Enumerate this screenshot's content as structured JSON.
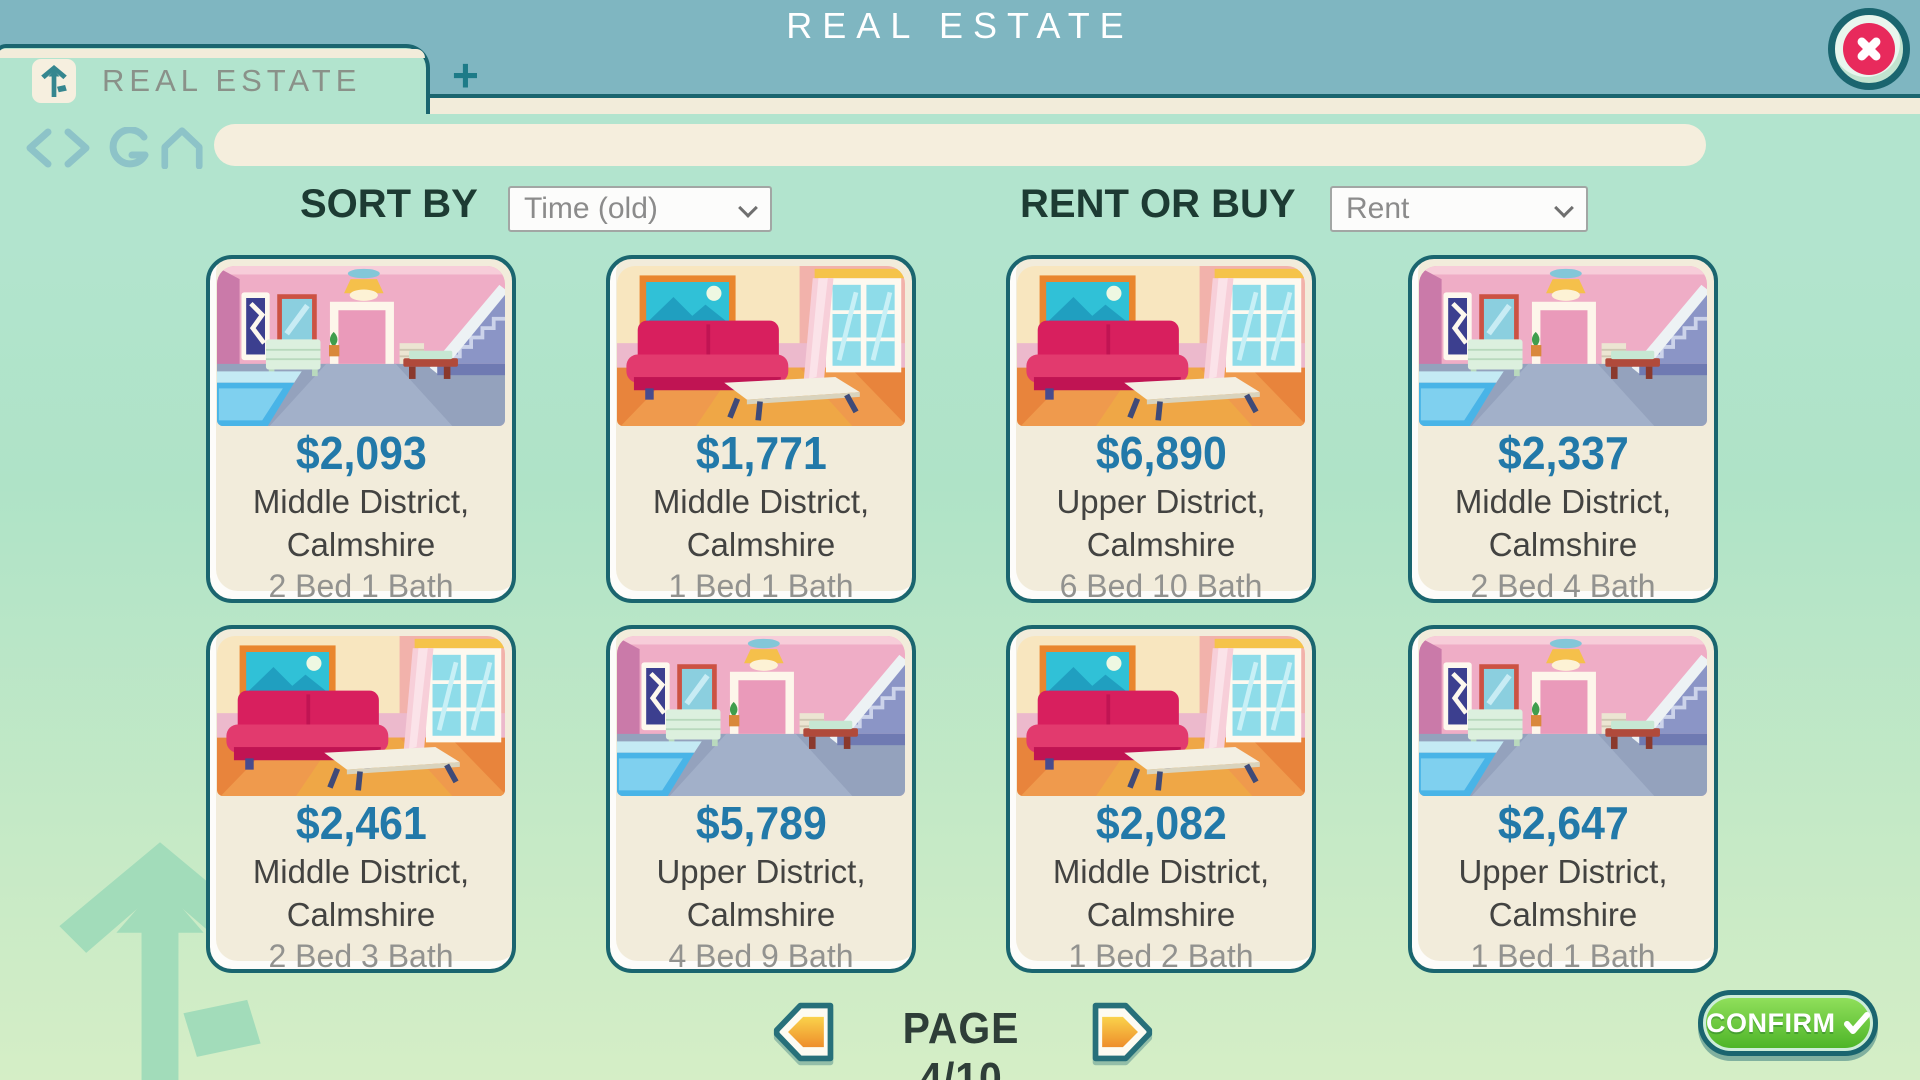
{
  "colors": {
    "header_teal": "#7fb6c1",
    "mint": "#b2e4ce",
    "cream": "#f2ecda",
    "border_teal": "#1a656f",
    "price_blue": "#2279a9",
    "confirm_green": "#4eb528",
    "close_pink": "#e82a5c",
    "arrow_orange": "#ee8e2b"
  },
  "header": {
    "title": "REAL ESTATE",
    "close_icon": "close-x"
  },
  "browser": {
    "tab_label": "REAL ESTATE",
    "tab_icon": "house-arrow-logo",
    "new_tab_label": "+",
    "url_value": "",
    "nav_icons": [
      "back-chevron",
      "forward-chevron",
      "refresh-arrow",
      "home-outline"
    ]
  },
  "filters": {
    "sort_label": "SORT BY",
    "sort_value": "Time (old)",
    "rent_label": "RENT OR BUY",
    "rent_value": "Rent"
  },
  "listings": [
    {
      "price": "$2,093",
      "location": "Middle District,",
      "city": "Calmshire",
      "beds_baths": "2 Bed 1 Bath",
      "image": "room-stairs-pool"
    },
    {
      "price": "$1,771",
      "location": "Middle District,",
      "city": "Calmshire",
      "beds_baths": "1 Bed 1 Bath",
      "image": "room-sofa"
    },
    {
      "price": "$6,890",
      "location": "Upper District,",
      "city": "Calmshire",
      "beds_baths": "6 Bed 10 Bath",
      "image": "room-sofa"
    },
    {
      "price": "$2,337",
      "location": "Middle District,",
      "city": "Calmshire",
      "beds_baths": "2 Bed 4 Bath",
      "image": "room-stairs-pool"
    },
    {
      "price": "$2,461",
      "location": "Middle District,",
      "city": "Calmshire",
      "beds_baths": "2 Bed 3 Bath",
      "image": "room-sofa"
    },
    {
      "price": "$5,789",
      "location": "Upper District,",
      "city": "Calmshire",
      "beds_baths": "4 Bed 9 Bath",
      "image": "room-stairs-pool"
    },
    {
      "price": "$2,082",
      "location": "Middle District,",
      "city": "Calmshire",
      "beds_baths": "1 Bed 2 Bath",
      "image": "room-sofa"
    },
    {
      "price": "$2,647",
      "location": "Upper District,",
      "city": "Calmshire",
      "beds_baths": "1 Bed 1 Bath",
      "image": "room-stairs-pool"
    }
  ],
  "pagination": {
    "label": "PAGE 4/10",
    "prev_icon": "arrow-left",
    "next_icon": "arrow-right"
  },
  "confirm": {
    "label": "CONFIRM",
    "icon": "checkmark"
  }
}
